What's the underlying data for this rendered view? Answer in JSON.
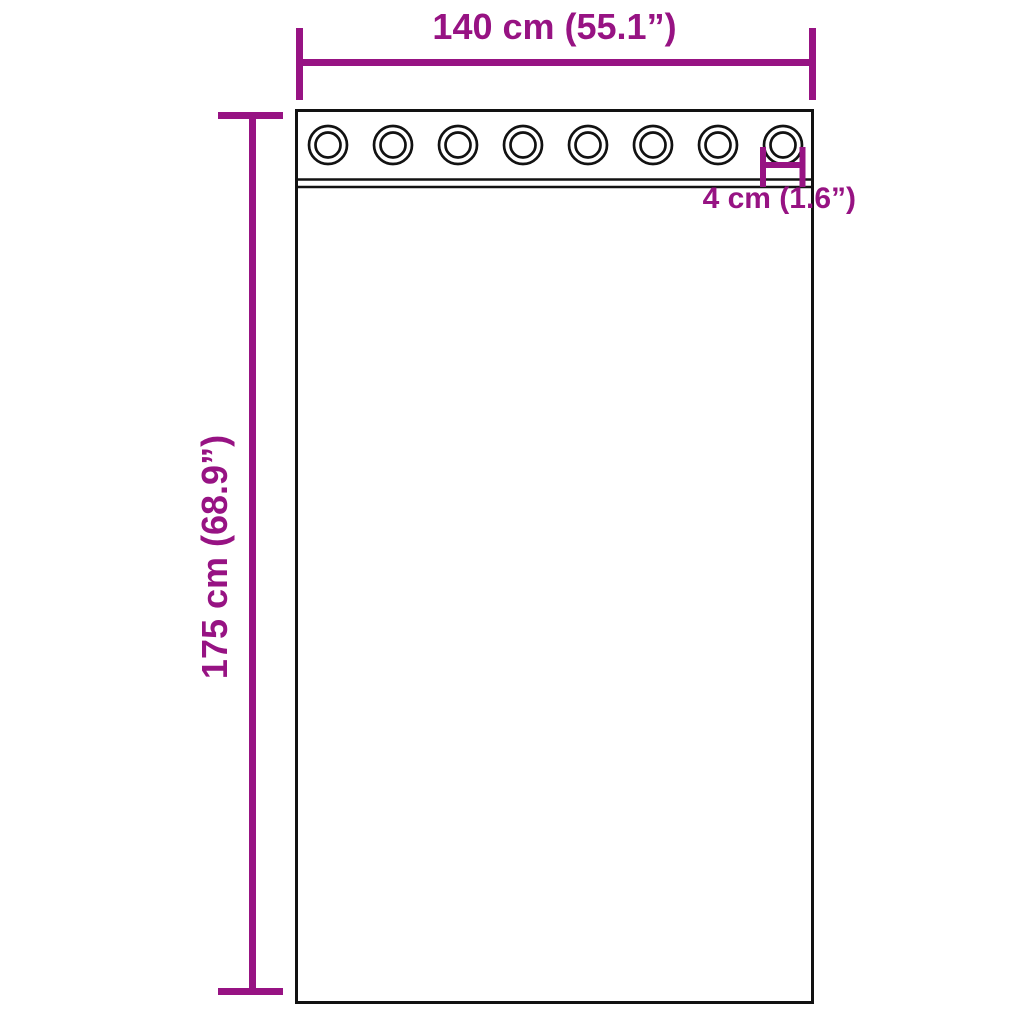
{
  "diagram": {
    "type": "product-dimension-diagram",
    "product": "Sheer curtain panel with grommets",
    "grommet_count": 8,
    "dimensions": {
      "width_label": "140 cm (55.1”)",
      "height_label": "175 cm (68.9”)",
      "grommet_label": "4 cm (1.6”)"
    },
    "colors": {
      "dimension": "#971383",
      "outline": "#121212",
      "background": "#FFFFFF"
    }
  }
}
